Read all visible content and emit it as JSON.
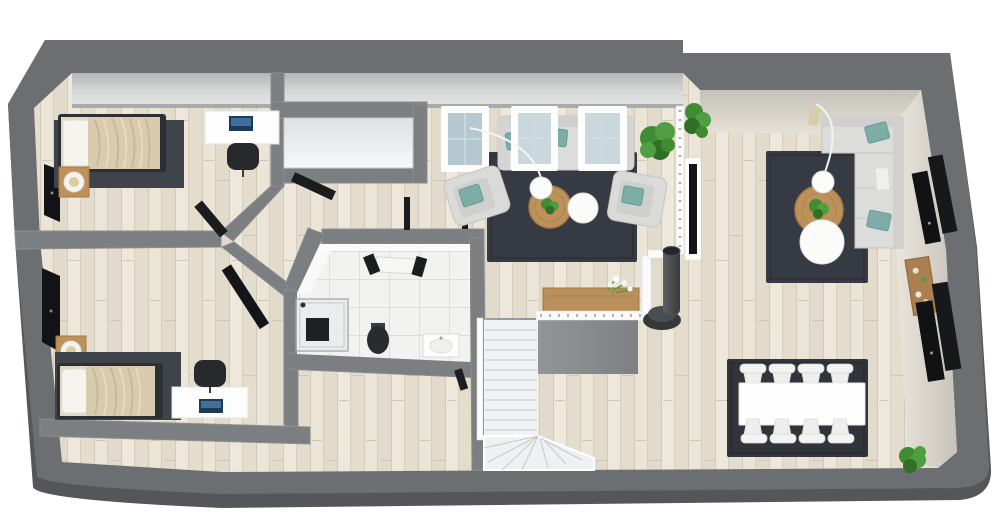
{
  "scene": {
    "title": "3D floor plan render — attic storey, top-down view",
    "style": "photoreal 3D floor plan",
    "background": "#ffffff"
  },
  "palette": {
    "outer_wall": "#6c6f72",
    "wall_shadow": "#54575a",
    "inner_wall": "#7c7f82",
    "wood_floor": "#e8e2d5",
    "tile_floor": "#f2f2f0",
    "slope_ceiling_gray": "#c9cccb",
    "slope_ceiling_beige": "#d8d4cb",
    "rug_dark": "#363b43",
    "sofa_gray": "#dcdcda",
    "pillow_teal": "#7dada7",
    "wood_furniture": "#bd9159",
    "blanket_beige": "#d8cbae",
    "plant_green": "#3f8c33",
    "black_panels": "#121316",
    "stairs_white": "#f0f2f3"
  },
  "rooms": {
    "bedroom_top": {
      "label": "Bedroom (top left)",
      "furniture": [
        "single bed with beige blanket",
        "dark area rug",
        "wood nightstand with lamp",
        "white desk with laptop",
        "black office chair",
        "black wall panel"
      ]
    },
    "bedroom_bottom": {
      "label": "Bedroom (bottom left)",
      "furniture": [
        "single bed with beige blanket",
        "dark area rug",
        "wood nightstand with lamp",
        "white desk with laptop",
        "black office chair",
        "black wardrobe panel"
      ]
    },
    "hallway": {
      "label": "Hallway hub",
      "furniture": [
        "open dark doors"
      ]
    },
    "closet": {
      "label": "Walk-in closet",
      "furniture": [
        "open dark door"
      ]
    },
    "bathroom": {
      "label": "Bathroom",
      "furniture": [
        "glass shower enclosure",
        "toilet",
        "washbasin",
        "open door"
      ]
    },
    "living_room": {
      "label": "Living room (center)",
      "furniture": [
        "3-seat gray sofa",
        "3 roof windows",
        "2 gray armchairs with teal pillows",
        "round wood coffee table with plant",
        "round white side table",
        "white globe floor lamp",
        "dark navy rug",
        "2 potted plants"
      ]
    },
    "lounge": {
      "label": "Lounge (right)",
      "furniture": [
        "L-shaped sectional sofa with teal pillows",
        "round wood coffee table with plant",
        "white round ottoman",
        "arc floor lamp",
        "dark navy rug",
        "4 black roof windows",
        "wood wall shelf with decor"
      ]
    },
    "dining_area": {
      "label": "Dining area",
      "furniture": [
        "white rectangular dining table",
        "8 white chairs",
        "dark rug",
        "potted plant"
      ]
    },
    "stair_area": {
      "label": "Staircase landing",
      "furniture": [
        "white L-shaped staircase",
        "white balustrade railing",
        "wood console table with flowers",
        "black wood-burning stove with flue",
        "white TV board with screen"
      ]
    }
  }
}
